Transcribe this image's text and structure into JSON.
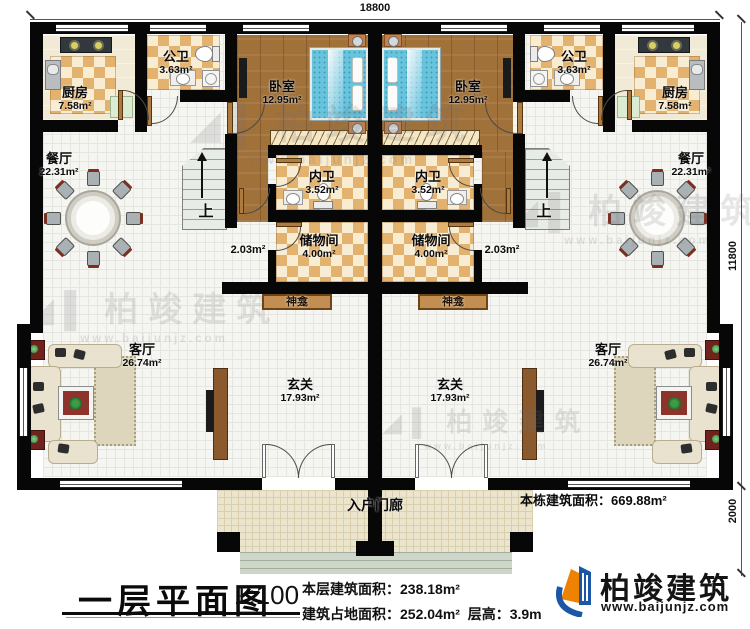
{
  "dimensions": {
    "width_top": "18800",
    "depth_right": "11800",
    "porch_depth": "2000"
  },
  "rooms": {
    "kitchen": {
      "name": "厨房",
      "area": "7.58m²"
    },
    "public_bath": {
      "name": "公卫",
      "area": "3.63m²"
    },
    "bedroom": {
      "name": "卧室",
      "area": "12.95m²"
    },
    "inner_bath": {
      "name": "内卫",
      "area": "3.52m²"
    },
    "storage": {
      "name": "储物间",
      "area": "4.00m²"
    },
    "shrine": {
      "name": "神龛"
    },
    "landing": {
      "area": "2.03m²"
    },
    "dining": {
      "name": "餐厅",
      "area": "22.31m²"
    },
    "living": {
      "name": "客厅",
      "area": "26.74m²"
    },
    "foyer": {
      "name": "玄关",
      "area": "17.93m²"
    },
    "porch": {
      "name": "入户门廊"
    },
    "stairs_up": "上"
  },
  "annotation": {
    "total_building_area": "本栋建筑面积：669.88m²"
  },
  "watermark": {
    "text": "柏竣建筑",
    "url": "www.baijunjz.com",
    "glyph": "◢▌"
  },
  "footer": {
    "title": "一层平面图",
    "scale": "1:100",
    "floor_area": "本层建筑面积：238.18m²",
    "footprint_area": "建筑占地面积：252.04m²",
    "floor_height": "层高：3.9m",
    "logo_text": "柏竣建筑",
    "logo_url": "www.baijunjz.com"
  }
}
